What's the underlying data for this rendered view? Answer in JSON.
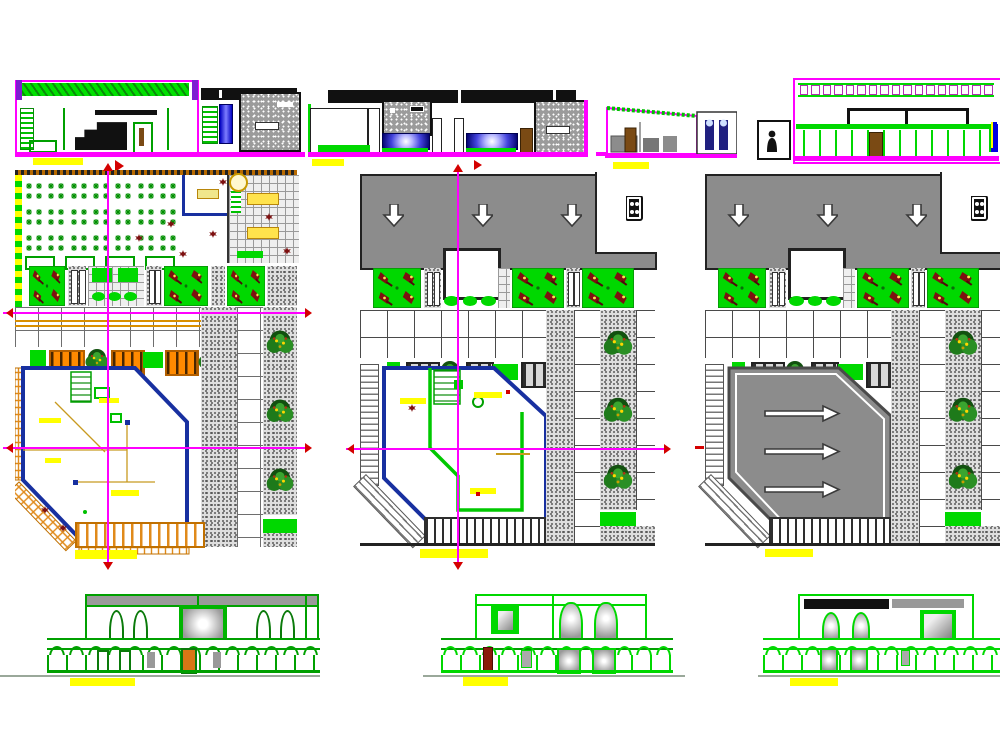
{
  "drawing": {
    "type": "architectural-cad-sheet",
    "panels": [
      {
        "id": "section-top-left",
        "name": "building-section-top-left"
      },
      {
        "id": "elevation-top-middle",
        "name": "street-elevation-top-middle"
      },
      {
        "id": "section-top-right",
        "name": "building-section-top-right"
      },
      {
        "id": "plan-ground",
        "name": "ground-floor-plan"
      },
      {
        "id": "plan-upper",
        "name": "upper-floor-plan"
      },
      {
        "id": "plan-roof",
        "name": "roof-plan"
      },
      {
        "id": "elevation-bottom-left",
        "name": "front-elevation-left"
      },
      {
        "id": "elevation-bottom-middle",
        "name": "front-elevation-middle"
      },
      {
        "id": "elevation-bottom-right",
        "name": "front-elevation-right"
      }
    ]
  },
  "palette": {
    "paper": "#ffffff",
    "magenta": "#ff00ff",
    "purple": "#7d1fd0",
    "green": "#00d800",
    "green2": "#00a000",
    "dgreen": "#0b6b0b",
    "tree": "#155d15",
    "yellow": "#ffff00",
    "navy": "#1830a0",
    "blue": "#0000e0",
    "orange": "#ff8a00",
    "doororange": "#d97616",
    "gray": "#8c8c8c",
    "lgray": "#d9d9d9",
    "dark": "#2e2e2e",
    "maroon": "#7d1010",
    "red": "#d40000",
    "brown": "#7a4a14",
    "tan": "#d09a28",
    "ground": "#9aa89a"
  },
  "counts": {
    "dining_tables": 21,
    "rect_tables": 4,
    "parapet_openings": 17,
    "roof_vent_arrows": 3,
    "ramp_arrows": 3,
    "trees_per_column": 3,
    "arcade_arches_left": 14,
    "arcade_arches_middle": 12,
    "arcade_arches_right": 12
  }
}
